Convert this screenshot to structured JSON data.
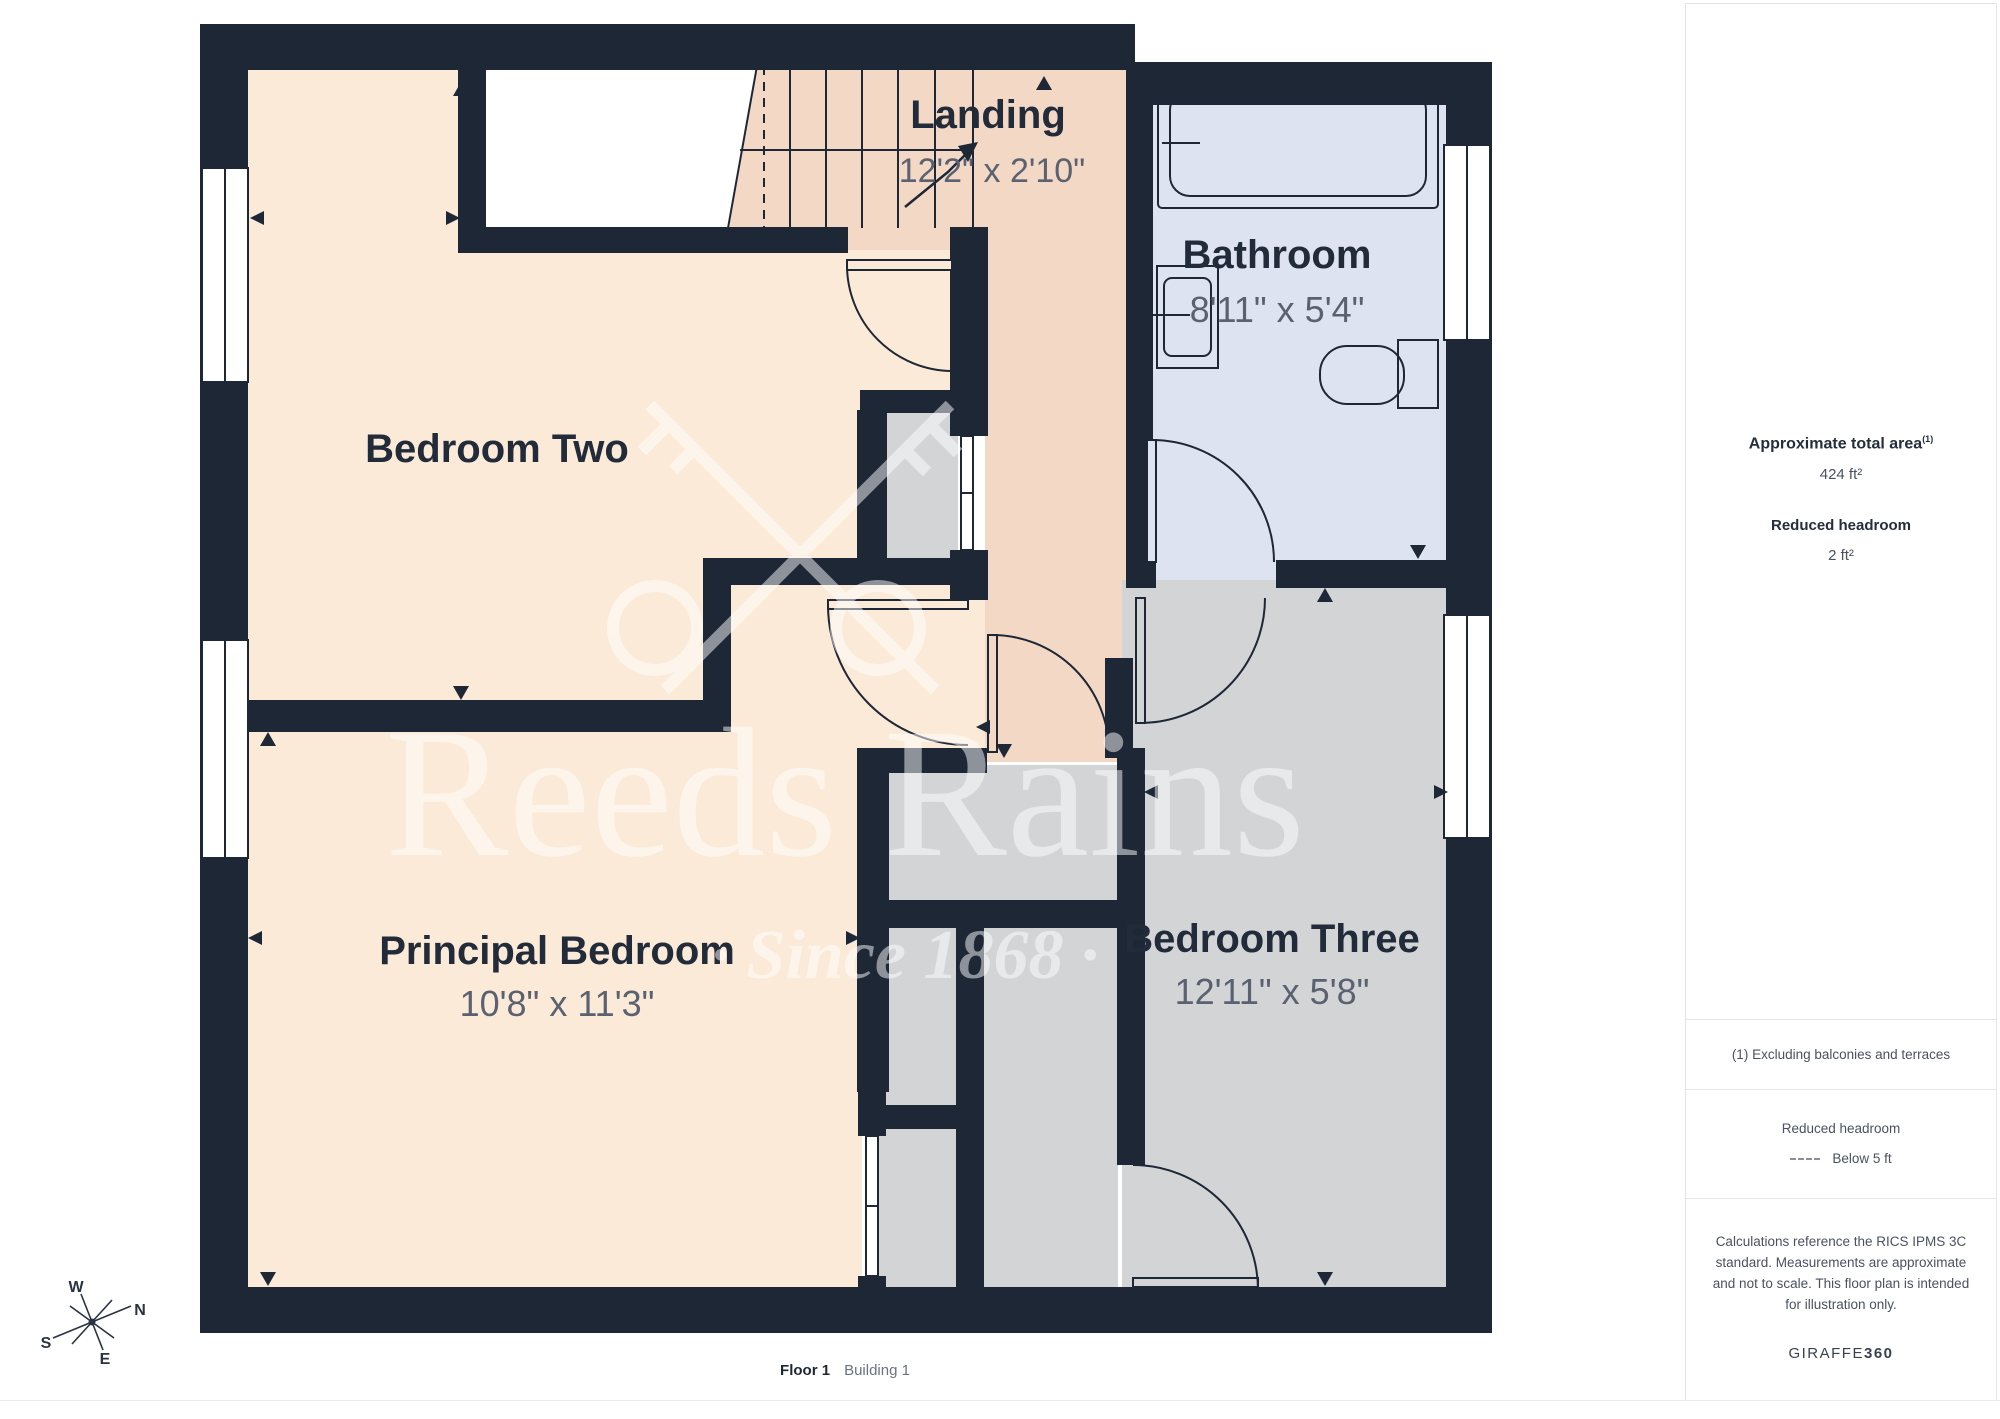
{
  "plan": {
    "rooms": [
      {
        "name": "Bedroom Two",
        "dims": ""
      },
      {
        "name": "Principal Bedroom",
        "dims": "10'8\" x 11'3\""
      },
      {
        "name": "Bedroom Three",
        "dims": "12'11\" x 5'8\""
      },
      {
        "name": "Bathroom",
        "dims": "8'11\" x 5'4\""
      },
      {
        "name": "Landing",
        "dims": "12'2\" x 2'10\""
      }
    ],
    "watermark": {
      "brand": "Reeds Rains",
      "tagline": "· Since 1868 ·"
    },
    "compass": {
      "n": "N",
      "s": "S",
      "e": "E",
      "w": "W"
    }
  },
  "sidebar": {
    "total_area_label": "Approximate total area",
    "total_area_superscript": "(1)",
    "total_area_value": "424 ft²",
    "reduced_headroom_label": "Reduced headroom",
    "reduced_headroom_value": "2 ft²",
    "footnote": "(1) Excluding balconies and terraces",
    "legend_title": "Reduced headroom",
    "legend_value": "Below 5 ft",
    "disclaimer": "Calculations reference the RICS IPMS 3C standard. Measurements are approximate and not to scale. This floor plan is intended for illustration only.",
    "brand_name": "GIRAFFE",
    "brand_number": "360"
  },
  "footer": {
    "floor": "Floor 1",
    "building": "Building 1"
  },
  "colors": {
    "wall": "#1d2736",
    "bedroom": "#fcead8",
    "landing": "#f3d8c5",
    "bathroom": "#dee3f1",
    "storage": "#d2d4d6",
    "dim_text": "#5a6170",
    "label_text": "#222b39"
  }
}
